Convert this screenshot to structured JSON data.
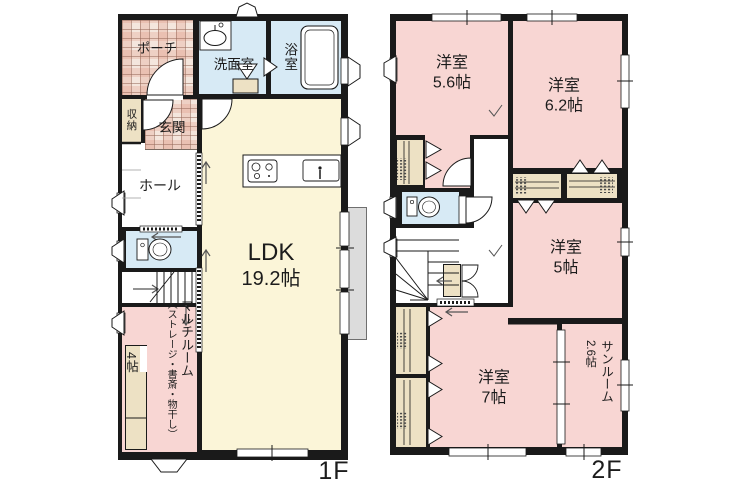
{
  "floor1": {
    "label": "1F",
    "rooms": {
      "porch": "ポーチ",
      "washroom": "洗面室",
      "bathroom": "浴室",
      "storage": "収納",
      "entrance": "玄関",
      "hall": "ホール",
      "ldk_name": "LDK",
      "ldk_size": "19.2帖",
      "multi_name": "マルチルーム",
      "multi_note": "（ストレージ・書斎・物干し）",
      "multi_size": "4帖"
    }
  },
  "floor2": {
    "label": "2F",
    "rooms": {
      "room1_name": "洋室",
      "room1_size": "5.6帖",
      "room2_name": "洋室",
      "room2_size": "6.2帖",
      "room3_name": "洋室",
      "room3_size": "5帖",
      "room4_name": "洋室",
      "room4_size": "7帖",
      "sunroom_name": "サンルーム",
      "sunroom_size": "2.6帖"
    }
  },
  "colors": {
    "wall": "#1a1a1a",
    "western_room_pink": "#f8d6d3",
    "ldk_cream": "#fbf5d8",
    "wet_area_blue": "#d7eaf5",
    "closet_beige": "#ede1c4",
    "tile_base": "#f4e6dd",
    "deck_gray": "#dcdcdc"
  }
}
